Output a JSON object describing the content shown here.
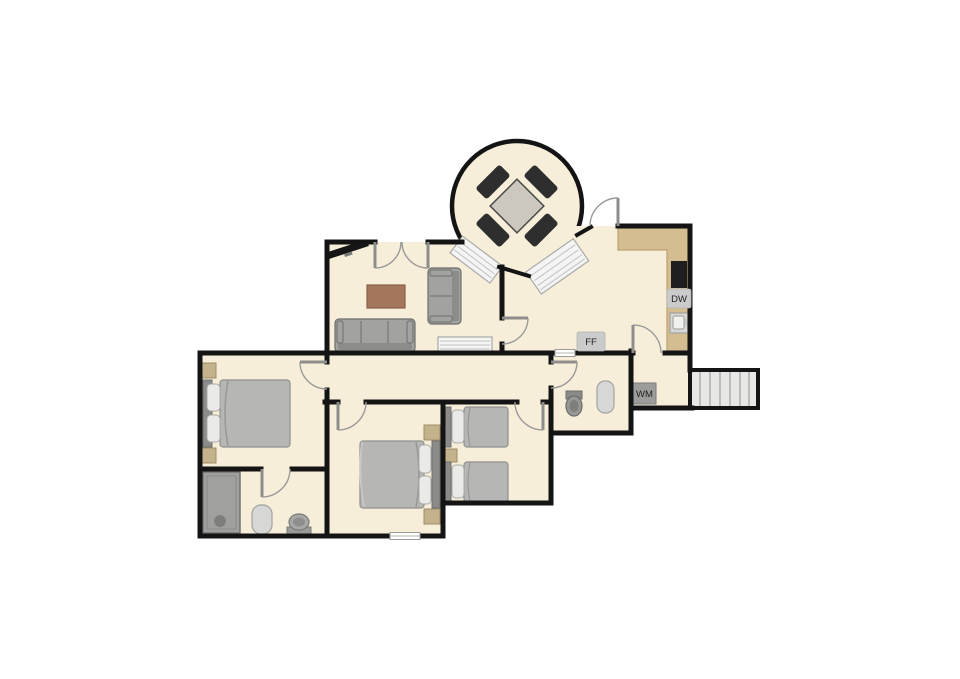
{
  "floorplan": {
    "labels": {
      "dishwasher": "DW",
      "fridge_freezer": "FF",
      "washing_machine": "WM"
    },
    "colors": {
      "floor": "#f6eed9",
      "wall": "#141414",
      "counter": "#d5bd92",
      "counter_edge": "#bba06f",
      "label_bg": "#cbcbcb",
      "label_text": "#222222",
      "appliance_dark": "#1e1e1e",
      "furniture": "#a2a2a0",
      "furniture_dark": "#8c8c8a",
      "furniture_edge": "#6e6e6c",
      "bed_duvet": "#b6b6b4",
      "pillow": "#eaeae8",
      "nightstand": "#c4b28c",
      "table_wood": "#a4765b",
      "radiator": "#f4f4f4",
      "stair": "#e7e7e5",
      "door": "#9a9a98",
      "wm_bg": "#9c9c9a"
    },
    "fixtures": [
      "round-conservatory",
      "dining-table",
      "dining-chairs",
      "tv",
      "coffee-table",
      "sofa-3-seat",
      "sofa-2-seat",
      "radiators",
      "kitchen-counter",
      "hob",
      "dishwasher",
      "kitchen-sink",
      "fridge-freezer",
      "double-beds",
      "single-beds",
      "nightstands",
      "shower",
      "toilets",
      "washbasins",
      "washing-machine",
      "stairs"
    ]
  }
}
